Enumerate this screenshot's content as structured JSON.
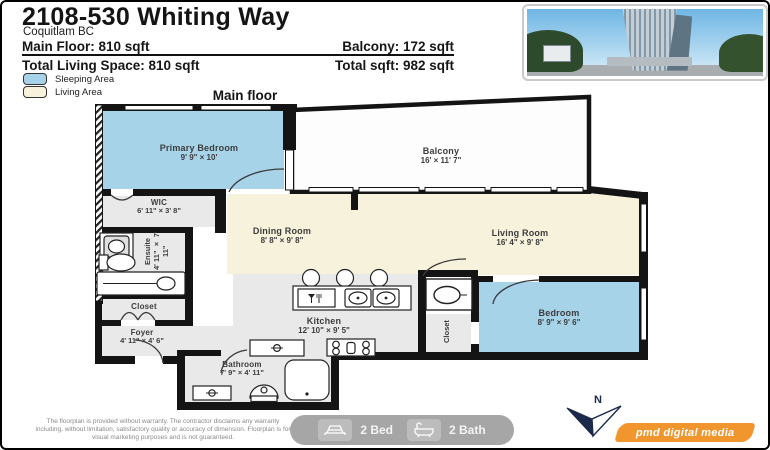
{
  "header": {
    "title": "2108-530 Whiting Way",
    "subtitle": "Coquitlam BC",
    "main_floor": "Main Floor: 810 sqft",
    "balcony_sqft": "Balcony: 172 sqft",
    "total_living": "Total Living Space: 810 sqft",
    "total_sqft": "Total sqft: 982 sqft"
  },
  "legend": {
    "sleeping_label": "Sleeping Area",
    "living_label": "Living Area",
    "sleeping_color": "#a7d3e9",
    "living_color": "#f7f2db"
  },
  "plan": {
    "floor_label": "Main floor",
    "rooms": {
      "primary_bedroom": {
        "name": "Primary Bedroom",
        "dims": "9' 9\" × 10'"
      },
      "balcony": {
        "name": "Balcony",
        "dims": "16'  × 11' 7\""
      },
      "wic": {
        "name": "WIC",
        "dims": "6' 11\" × 3' 8\""
      },
      "ensuite": {
        "name": "Ensuite",
        "dims": "4' 11\" × 7' 11\""
      },
      "closet_entry": {
        "name": "Closet"
      },
      "foyer": {
        "name": "Foyer",
        "dims": "4' 11\" × 4' 6\""
      },
      "dining_room": {
        "name": "Dining Room",
        "dims": "8' 8\" × 9' 8\""
      },
      "living_room": {
        "name": "Living Room",
        "dims": "16' 4\" × 9' 8\""
      },
      "kitchen": {
        "name": "Kitchen",
        "dims": "12' 10\" × 9' 5\""
      },
      "bathroom": {
        "name": "Bathroom",
        "dims": "7' 9\" × 4' 11\""
      },
      "bedroom": {
        "name": "Bedroom",
        "dims": "8' 9\" × 9' 6\""
      },
      "closet_bedroom": {
        "name": "Closet"
      }
    }
  },
  "footer": {
    "disclaimer": "The floorplan is provided without warranty. The contractor disclaims any warranty including, without limitation, satisfactory quality or accuracy of dimension. Floorplan is for visual marketing purposes and is not guaranteed.",
    "bed_badge": "2 Bed",
    "bath_badge": "2 Bath",
    "compass_label": "N",
    "brand": "pmd digital media"
  }
}
